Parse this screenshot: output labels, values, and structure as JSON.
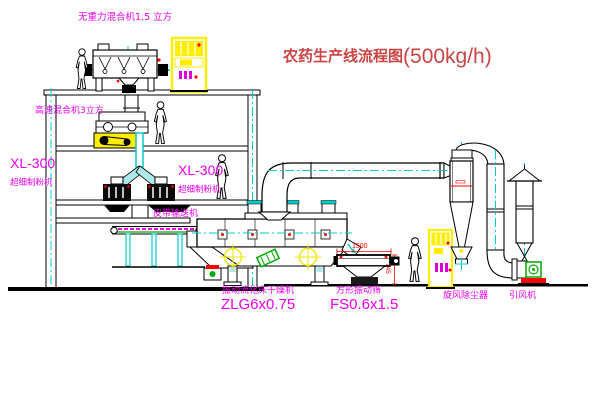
{
  "title": {
    "main": "农药生产线流程图",
    "capacity": "(500kg/h)"
  },
  "labels": {
    "gravity_mixer": "无重力混合机1.5 立方",
    "high_speed_mixer": "高速混合机3立方",
    "mill_left_model": "XL-300",
    "mill_left_name": "超细制粉机",
    "mill_right_model": "XL-300",
    "mill_right_name": "超细制粉机",
    "belt_conveyor": "皮带输送机",
    "dryer_name": "振动流化床干燥机",
    "dryer_model": "ZLG6x0.75",
    "sieve_name": "方形振动筛",
    "sieve_model": "FS0.6x1.5",
    "cyclone": "旋风除尘器",
    "fan": "引风机"
  },
  "dimensions": {
    "sieve_width": "1500",
    "sieve_height": "745"
  },
  "colors": {
    "outline": "#000000",
    "centerline": "#00cccc",
    "label": "#ee00ee",
    "title": "#cc4444",
    "dimension": "#ff0000",
    "cabinet": "#ffee00",
    "motor_green": "#00aa00"
  }
}
